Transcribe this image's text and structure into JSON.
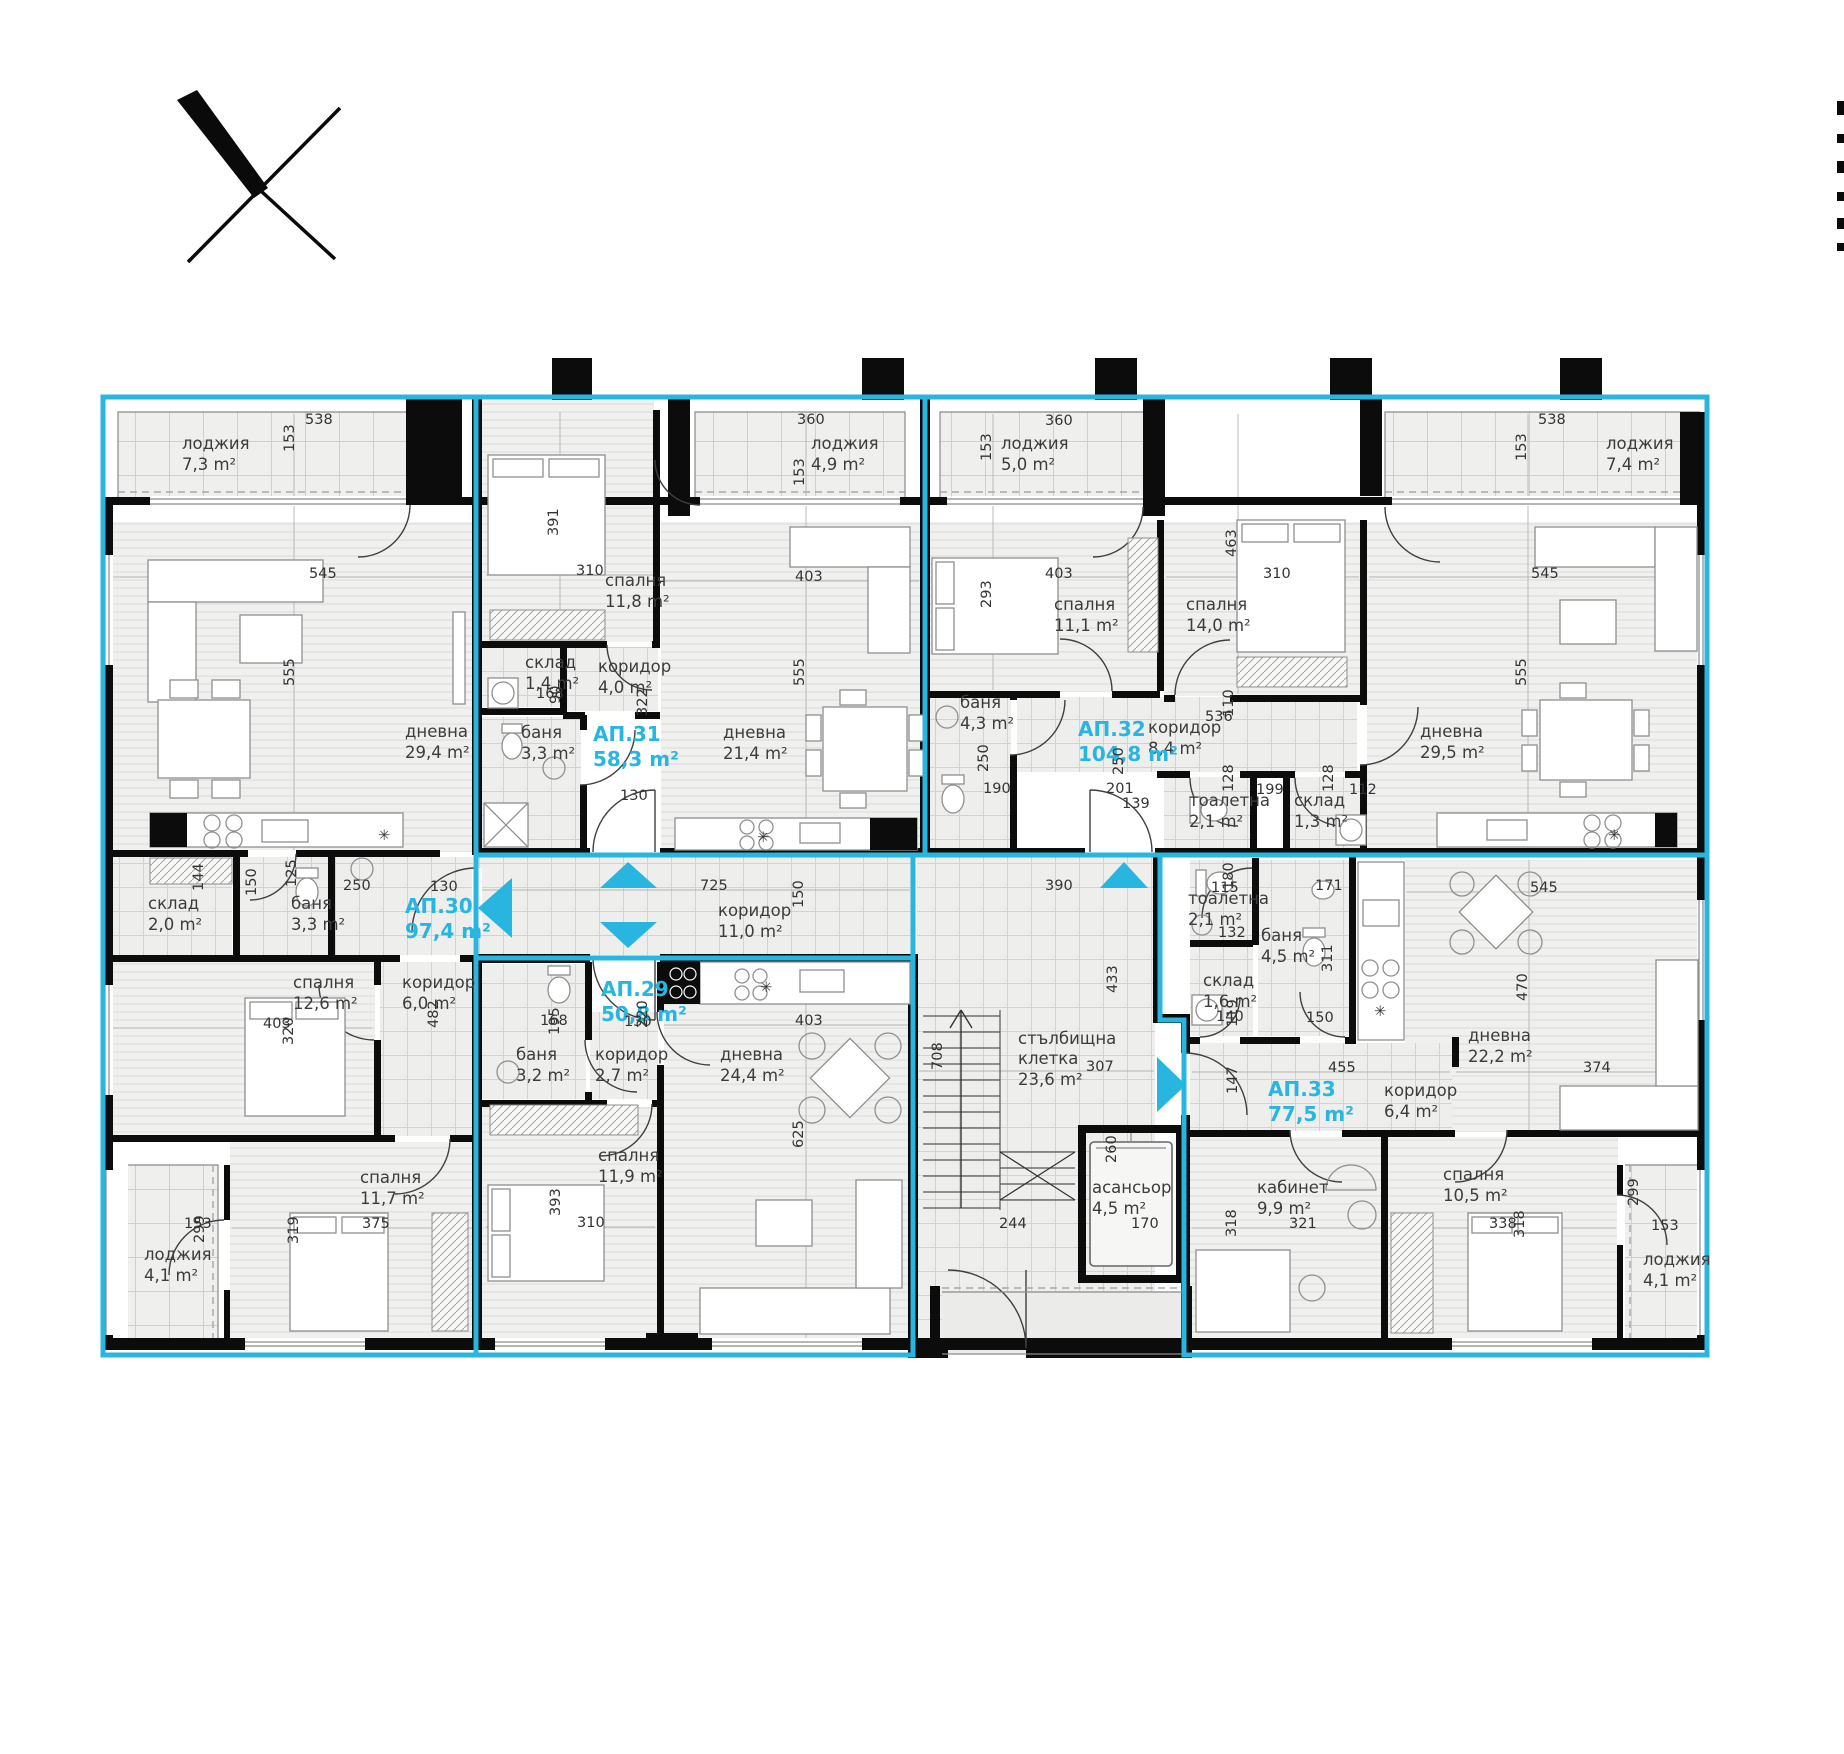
{
  "plan_title": "apartment-building-floor-plan",
  "colors": {
    "accent_cyan": "#28b6e0",
    "wall_black": "#0c0c0c",
    "label_gray": "#3c3c3c"
  },
  "apartments": [
    {
      "id": "АП.29",
      "area": "50,8 m²",
      "x": 601,
      "y": 996
    },
    {
      "id": "АП.30",
      "area": "97,4 m²",
      "x": 405,
      "y": 913
    },
    {
      "id": "АП.31",
      "area": "58,3 m²",
      "x": 593,
      "y": 741
    },
    {
      "id": "АП.32",
      "area": "104,8 m²",
      "x": 1078,
      "y": 736
    },
    {
      "id": "АП.33",
      "area": "77,5 m²",
      "x": 1268,
      "y": 1096
    }
  ],
  "rooms": [
    {
      "name": "лоджия",
      "area": "7,3 m²",
      "x": 182,
      "y": 449
    },
    {
      "name": "дневна",
      "area": "29,4 m²",
      "x": 405,
      "y": 737
    },
    {
      "name": "склад",
      "area": "2,0 m²",
      "x": 148,
      "y": 909
    },
    {
      "name": "баня",
      "area": "3,3 m²",
      "x": 291,
      "y": 909
    },
    {
      "name": "спалня",
      "area": "12,6 m²",
      "x": 293,
      "y": 988
    },
    {
      "name": "коридор",
      "area": "6,0 m²",
      "x": 402,
      "y": 988
    },
    {
      "name": "спалня",
      "area": "11,7 m²",
      "x": 360,
      "y": 1183
    },
    {
      "name": "лоджия",
      "area": "4,1 m²",
      "x": 144,
      "y": 1260
    },
    {
      "name": "спалня",
      "area": "11,8 m²",
      "x": 605,
      "y": 586
    },
    {
      "name": "склад",
      "area": "1,4 m²",
      "x": 525,
      "y": 668
    },
    {
      "name": "коридор",
      "area": "4,0 m²",
      "x": 598,
      "y": 672
    },
    {
      "name": "баня",
      "area": "3,3 m²",
      "x": 521,
      "y": 738
    },
    {
      "name": "дневна",
      "area": "21,4 m²",
      "x": 723,
      "y": 738
    },
    {
      "name": "лоджия",
      "area": "4,9 m²",
      "x": 811,
      "y": 449
    },
    {
      "name": "лоджия",
      "area": "5,0 m²",
      "x": 1001,
      "y": 449
    },
    {
      "name": "спалня",
      "area": "11,1 m²",
      "x": 1054,
      "y": 610
    },
    {
      "name": "баня",
      "area": "4,3 m²",
      "x": 960,
      "y": 708
    },
    {
      "name": "коридор",
      "area": "8,4 m²",
      "x": 1148,
      "y": 733
    },
    {
      "name": "спалня",
      "area": "14,0 m²",
      "x": 1186,
      "y": 610
    },
    {
      "name": "тоалетна",
      "area": "2,1 m²",
      "x": 1189,
      "y": 806
    },
    {
      "name": "склад",
      "area": "1,3 m²",
      "x": 1294,
      "y": 806
    },
    {
      "name": "дневна",
      "area": "29,5 m²",
      "x": 1420,
      "y": 737
    },
    {
      "name": "лоджия",
      "area": "7,4 m²",
      "x": 1606,
      "y": 449
    },
    {
      "name": "коридор",
      "area": "11,0 m²",
      "x": 718,
      "y": 916
    },
    {
      "name": "баня",
      "area": "3,2 m²",
      "x": 516,
      "y": 1060
    },
    {
      "name": "коридор",
      "area": "2,7 m²",
      "x": 595,
      "y": 1060
    },
    {
      "name": "дневна",
      "area": "24,4 m²",
      "x": 720,
      "y": 1060
    },
    {
      "name": "спалня",
      "area": "11,9 m²",
      "x": 598,
      "y": 1161
    },
    {
      "name": "стълбищна",
      "name2": "клетка",
      "area": "23,6 m²",
      "x": 1018,
      "y": 1044
    },
    {
      "name": "асансьор",
      "area": "4,5 m²",
      "x": 1092,
      "y": 1193
    },
    {
      "name": "тоалетна",
      "area": "2,1 m²",
      "x": 1188,
      "y": 904
    },
    {
      "name": "баня",
      "area": "4,5 m²",
      "x": 1261,
      "y": 941
    },
    {
      "name": "склад",
      "area": "1,6 m²",
      "x": 1203,
      "y": 986
    },
    {
      "name": "коридор",
      "area": "6,4 m²",
      "x": 1384,
      "y": 1096
    },
    {
      "name": "дневна",
      "area": "22,2 m²",
      "x": 1468,
      "y": 1041
    },
    {
      "name": "кабинет",
      "area": "9,9 m²",
      "x": 1257,
      "y": 1193
    },
    {
      "name": "спалня",
      "area": "10,5 m²",
      "x": 1443,
      "y": 1180
    },
    {
      "name": "лоджия",
      "area": "4,1 m²",
      "x": 1643,
      "y": 1265
    }
  ],
  "dims": [
    {
      "t": "538",
      "x": 305,
      "y": 424
    },
    {
      "t": "153",
      "x": 294,
      "y": 452,
      "r": 1
    },
    {
      "t": "545",
      "x": 309,
      "y": 578
    },
    {
      "t": "555",
      "x": 294,
      "y": 686,
      "r": 1
    },
    {
      "t": "360",
      "x": 797,
      "y": 424
    },
    {
      "t": "153",
      "x": 804,
      "y": 486,
      "r": 1
    },
    {
      "t": "391",
      "x": 558,
      "y": 536,
      "r": 1
    },
    {
      "t": "310",
      "x": 576,
      "y": 575
    },
    {
      "t": "322",
      "x": 647,
      "y": 716,
      "r": 1
    },
    {
      "t": "168",
      "x": 536,
      "y": 698
    },
    {
      "t": "90",
      "x": 560,
      "y": 704,
      "r": 1
    },
    {
      "t": "130",
      "x": 620,
      "y": 800
    },
    {
      "t": "403",
      "x": 795,
      "y": 581
    },
    {
      "t": "555",
      "x": 804,
      "y": 686,
      "r": 1
    },
    {
      "t": "360",
      "x": 1045,
      "y": 425
    },
    {
      "t": "153",
      "x": 991,
      "y": 461,
      "r": 1
    },
    {
      "t": "403",
      "x": 1045,
      "y": 578
    },
    {
      "t": "293",
      "x": 991,
      "y": 608,
      "r": 1
    },
    {
      "t": "310",
      "x": 1263,
      "y": 578
    },
    {
      "t": "463",
      "x": 1236,
      "y": 557,
      "r": 1
    },
    {
      "t": "536",
      "x": 1205,
      "y": 721
    },
    {
      "t": "110",
      "x": 1233,
      "y": 717,
      "r": 1
    },
    {
      "t": "190",
      "x": 983,
      "y": 793
    },
    {
      "t": "250",
      "x": 988,
      "y": 772,
      "r": 1
    },
    {
      "t": "201",
      "x": 1106,
      "y": 793
    },
    {
      "t": "139",
      "x": 1122,
      "y": 808
    },
    {
      "t": "250",
      "x": 1123,
      "y": 775,
      "r": 1
    },
    {
      "t": "128",
      "x": 1233,
      "y": 792,
      "r": 1
    },
    {
      "t": "199",
      "x": 1256,
      "y": 794
    },
    {
      "t": "128",
      "x": 1333,
      "y": 792,
      "r": 1
    },
    {
      "t": "112",
      "x": 1349,
      "y": 794
    },
    {
      "t": "538",
      "x": 1538,
      "y": 424
    },
    {
      "t": "153",
      "x": 1526,
      "y": 461,
      "r": 1
    },
    {
      "t": "545",
      "x": 1531,
      "y": 578
    },
    {
      "t": "555",
      "x": 1526,
      "y": 686,
      "r": 1
    },
    {
      "t": "144",
      "x": 203,
      "y": 891,
      "r": 1
    },
    {
      "t": "150",
      "x": 256,
      "y": 896,
      "r": 1
    },
    {
      "t": "125",
      "x": 296,
      "y": 887,
      "r": 1
    },
    {
      "t": "250",
      "x": 343,
      "y": 890
    },
    {
      "t": "130",
      "x": 430,
      "y": 891
    },
    {
      "t": "403",
      "x": 263,
      "y": 1028
    },
    {
      "t": "320",
      "x": 293,
      "y": 1045,
      "r": 1
    },
    {
      "t": "482",
      "x": 438,
      "y": 1028,
      "r": 1
    },
    {
      "t": "153",
      "x": 184,
      "y": 1228
    },
    {
      "t": "299",
      "x": 204,
      "y": 1243,
      "r": 1
    },
    {
      "t": "375",
      "x": 362,
      "y": 1228
    },
    {
      "t": "319",
      "x": 298,
      "y": 1244,
      "r": 1
    },
    {
      "t": "725",
      "x": 700,
      "y": 890
    },
    {
      "t": "150",
      "x": 803,
      "y": 908,
      "r": 1
    },
    {
      "t": "390",
      "x": 1045,
      "y": 890
    },
    {
      "t": "433",
      "x": 1117,
      "y": 993,
      "r": 1
    },
    {
      "t": "708",
      "x": 942,
      "y": 1070,
      "r": 1
    },
    {
      "t": "307",
      "x": 1086,
      "y": 1071
    },
    {
      "t": "260",
      "x": 1116,
      "y": 1163,
      "r": 1
    },
    {
      "t": "244",
      "x": 999,
      "y": 1228
    },
    {
      "t": "170",
      "x": 1131,
      "y": 1228
    },
    {
      "t": "168",
      "x": 540,
      "y": 1025
    },
    {
      "t": "195",
      "x": 559,
      "y": 1035,
      "r": 1
    },
    {
      "t": "130",
      "x": 624,
      "y": 1026
    },
    {
      "t": "220",
      "x": 647,
      "y": 1028,
      "r": 1
    },
    {
      "t": "403",
      "x": 795,
      "y": 1025
    },
    {
      "t": "625",
      "x": 803,
      "y": 1148,
      "r": 1
    },
    {
      "t": "393",
      "x": 560,
      "y": 1216,
      "r": 1
    },
    {
      "t": "310",
      "x": 577,
      "y": 1227
    },
    {
      "t": "115",
      "x": 1211,
      "y": 892
    },
    {
      "t": "180",
      "x": 1233,
      "y": 890,
      "r": 1
    },
    {
      "t": "171",
      "x": 1315,
      "y": 890
    },
    {
      "t": "132",
      "x": 1218,
      "y": 937
    },
    {
      "t": "311",
      "x": 1332,
      "y": 972,
      "r": 1
    },
    {
      "t": "140",
      "x": 1216,
      "y": 1021
    },
    {
      "t": "119",
      "x": 1237,
      "y": 1027,
      "r": 1
    },
    {
      "t": "150",
      "x": 1306,
      "y": 1022
    },
    {
      "t": "455",
      "x": 1328,
      "y": 1072
    },
    {
      "t": "147",
      "x": 1237,
      "y": 1094,
      "r": 1
    },
    {
      "t": "545",
      "x": 1530,
      "y": 892
    },
    {
      "t": "470",
      "x": 1527,
      "y": 1001,
      "r": 1
    },
    {
      "t": "374",
      "x": 1583,
      "y": 1072
    },
    {
      "t": "321",
      "x": 1289,
      "y": 1228
    },
    {
      "t": "318",
      "x": 1236,
      "y": 1237,
      "r": 1
    },
    {
      "t": "338",
      "x": 1489,
      "y": 1228
    },
    {
      "t": "318",
      "x": 1524,
      "y": 1238,
      "r": 1
    },
    {
      "t": "299",
      "x": 1638,
      "y": 1206,
      "r": 1
    },
    {
      "t": "153",
      "x": 1651,
      "y": 1230
    },
    {
      "t": "✳",
      "x": 378,
      "y": 840
    },
    {
      "t": "✳",
      "x": 757,
      "y": 842
    },
    {
      "t": "✳",
      "x": 760,
      "y": 992
    },
    {
      "t": "✳",
      "x": 1608,
      "y": 840
    },
    {
      "t": "✳",
      "x": 1374,
      "y": 1016
    }
  ]
}
